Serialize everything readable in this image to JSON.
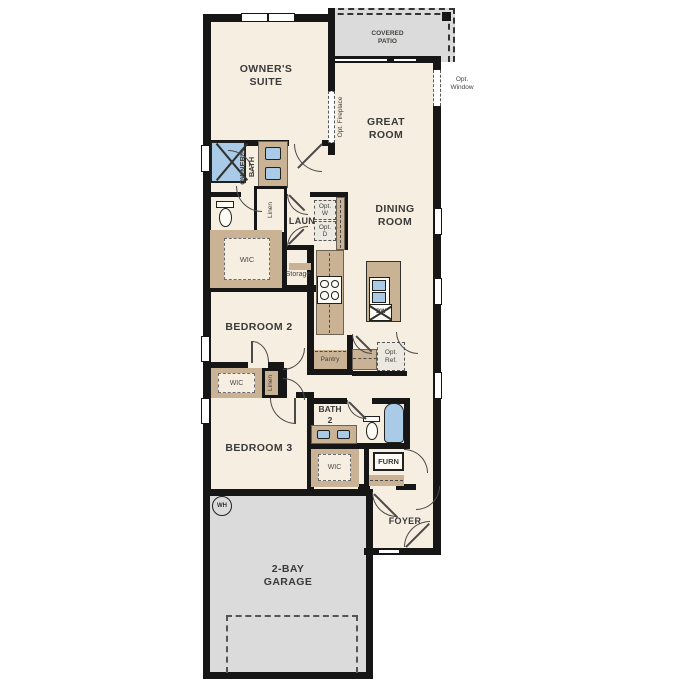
{
  "rooms": {
    "owners_suite": "OWNER'S\nSUITE",
    "covered_patio": "COVERED\nPATIO",
    "great_room": "GREAT\nROOM",
    "dining_room": "DINING\nROOM",
    "owners_bath": "OWNER'S\nBATH",
    "laundry": "LAUN",
    "bedroom_2": "BEDROOM 2",
    "bedroom_3": "BEDROOM 3",
    "bath_2": "BATH\n2",
    "foyer": "FOYER",
    "garage": "2-BAY\nGARAGE"
  },
  "closets": {
    "owners_wic": "WIC",
    "bedroom2_wic": "WIC",
    "bath2_wic": "WIC",
    "linen_bath": "Linen",
    "linen_hall": "Linen",
    "storage": "Storage",
    "pantry": "Pantry"
  },
  "options": {
    "fireplace": "Opt. Fireplace",
    "window": "Opt.\nWindow",
    "washer": "Opt.\nW",
    "dryer": "Opt.\nD",
    "refrigerator": "Opt.\nRef."
  },
  "equipment": {
    "furnace": "FURN",
    "dishwasher": "DW",
    "water_heater": "WH"
  },
  "colors": {
    "floor": "#f6eee0",
    "wall": "#161616",
    "cabinet": "#c9b394",
    "fixture": "#a9cbe8",
    "concrete": "#dbdbdb",
    "label": "#3a3a3a"
  }
}
